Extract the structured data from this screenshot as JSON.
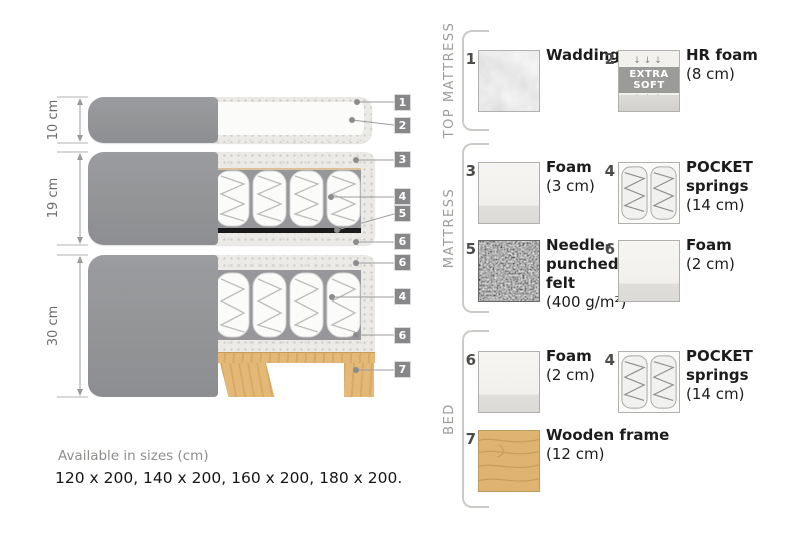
{
  "diagram": {
    "dimensions": [
      {
        "label": "10 cm"
      },
      {
        "label": "19 cm"
      },
      {
        "label": "30 cm"
      }
    ],
    "callouts": [
      {
        "num": "1"
      },
      {
        "num": "2"
      },
      {
        "num": "3"
      },
      {
        "num": "4"
      },
      {
        "num": "5"
      },
      {
        "num": "6"
      },
      {
        "num": "6"
      },
      {
        "num": "4"
      },
      {
        "num": "6"
      },
      {
        "num": "7"
      }
    ]
  },
  "legend": {
    "sections": [
      {
        "title": "TOP MATTRESS",
        "items": [
          {
            "num": "1",
            "name": "Wadding",
            "size": ""
          },
          {
            "num": "2",
            "name": "HR foam",
            "size": "(8 cm)",
            "badge": "EXTRA SOFT",
            "arrows_down": "↓↓↓",
            "arrows_up": "↑↑↑"
          }
        ]
      },
      {
        "title": "MATTRESS",
        "items": [
          {
            "num": "3",
            "name": "Foam",
            "size": "(3 cm)"
          },
          {
            "num": "4",
            "name": "POCKET springs",
            "size": "(14 cm)"
          },
          {
            "num": "5",
            "name": "Needle-punched felt",
            "size": "(400 g/m²)"
          },
          {
            "num": "6",
            "name": "Foam",
            "size": "(2 cm)"
          }
        ]
      },
      {
        "title": "BED",
        "items": [
          {
            "num": "6",
            "name": "Foam",
            "size": "(2 cm)"
          },
          {
            "num": "4",
            "name": "POCKET springs",
            "size": "(14 cm)"
          },
          {
            "num": "7",
            "name": "Wooden frame",
            "size": "(12 cm)"
          }
        ]
      }
    ]
  },
  "footer": {
    "availability": "Available in sizes (cm)",
    "sizes": "120 x 200, 140 x 200, 160 x 200, 180 x 200."
  },
  "colors": {
    "cover_gray": "#96979a",
    "callout_chip": "#87878a",
    "speckle_foam": "#eceae7",
    "springs_background": "#97979b",
    "felt_black": "#1a1a1a",
    "wood": "#e4b977",
    "bracket_gray": "#cbcac7"
  }
}
